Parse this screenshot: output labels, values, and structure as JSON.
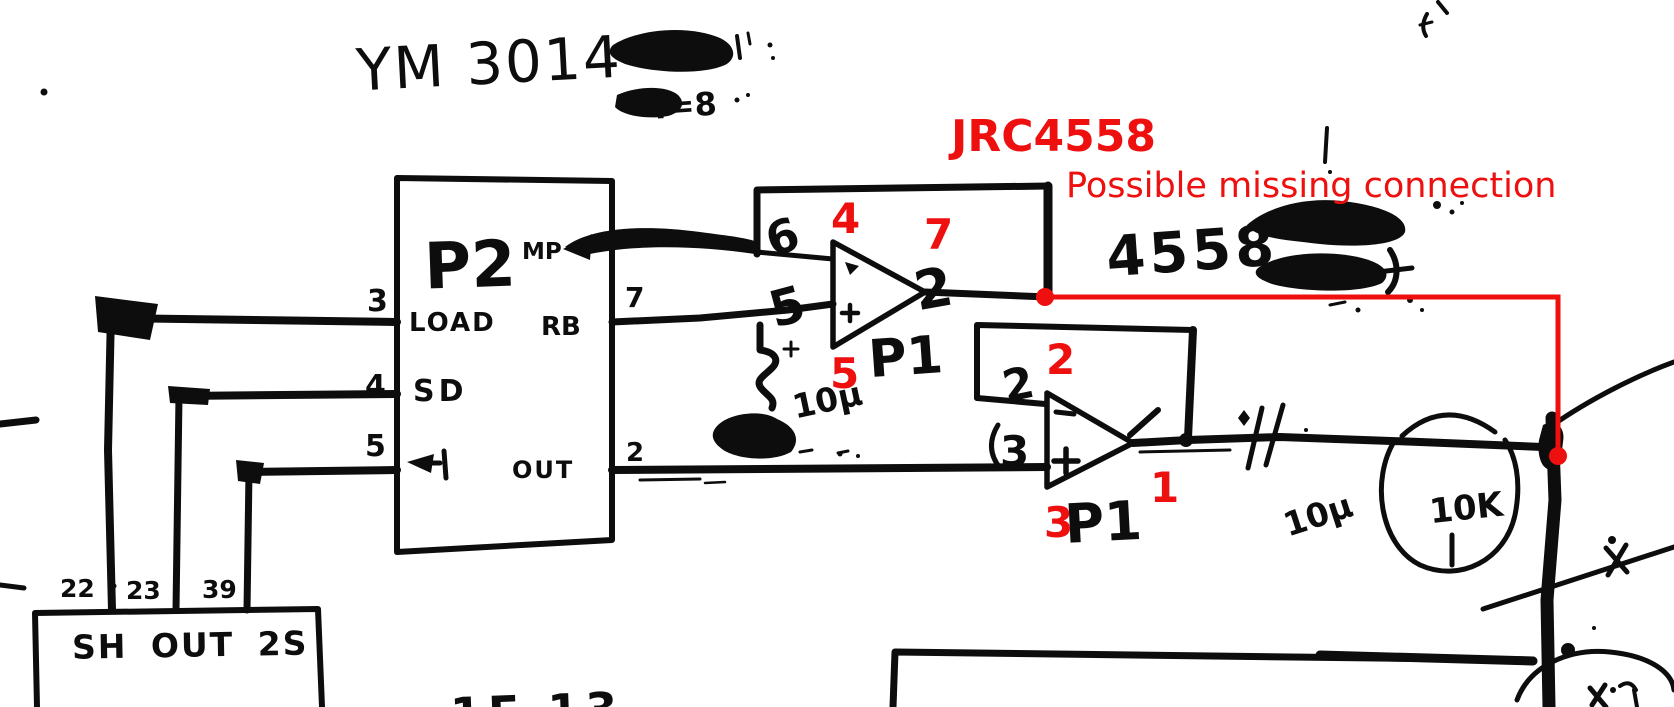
{
  "annotation": {
    "color": "#ee0f0f",
    "ic_label": "JRC4558",
    "note": "Possible missing connection",
    "pins": {
      "op1_inv": "4",
      "op1_out": "7",
      "op1_noninv": "5",
      "op2_inv": "2",
      "op2_out": "1",
      "op2_noninv": "3"
    }
  },
  "schematic": {
    "ink_color": "#0d0d0d",
    "paper_color": "#ffffff",
    "dac_title": "YM 3014",
    "top_scribble": "4=8",
    "hw_ic": "4558",
    "chip": {
      "designator": "P2",
      "mp": "MP",
      "load": "LOAD",
      "rb": "RB",
      "sd": "SD",
      "out": "OUT",
      "pin3": "3",
      "pin4": "4",
      "pin5": "5",
      "pin7": "7",
      "pin2": "2"
    },
    "opamp1": {
      "hw_inv_pin": "6",
      "hw_noninv_pin": "5",
      "hw_out_pin": "2",
      "label": "P1"
    },
    "opamp2": {
      "hw_in_pin": "2",
      "hw_noninv_pin": "3",
      "label": "P1"
    },
    "cap1_value": "10μ",
    "cap2_value": "10μ",
    "resistor_value": "10K",
    "shift_box": {
      "label": "SH OUT 2S",
      "pin22": "22",
      "pin23": "23",
      "pin39": "39"
    },
    "bottom_partial": "1F 13"
  }
}
